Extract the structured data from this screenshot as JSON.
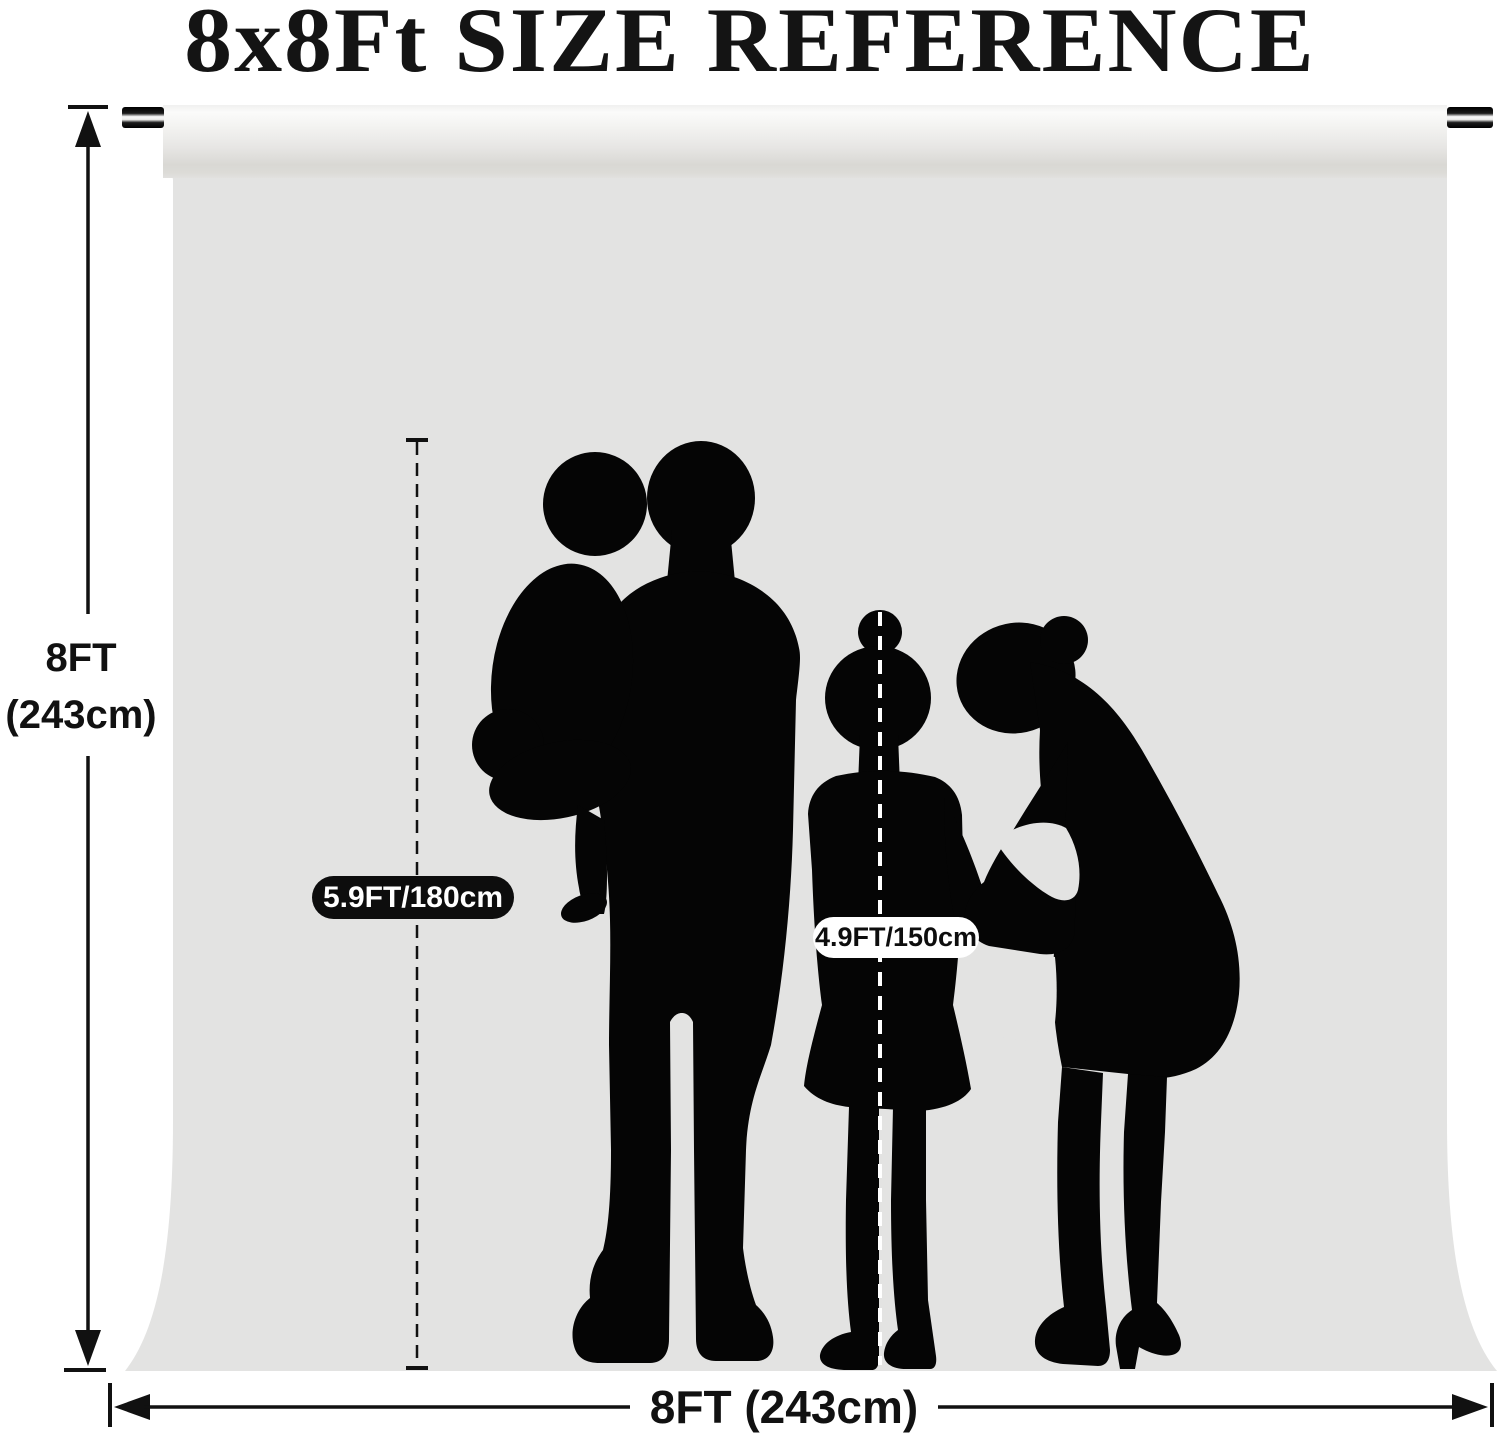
{
  "title": "8x8Ft SIZE REFERENCE",
  "backdrop": {
    "height_label_line1": "8FT",
    "height_label_line2": "(243cm)",
    "width_label": "8FT (243cm)"
  },
  "figures": {
    "adult_height_label": "5.9FT/180cm",
    "child_height_label": "4.9FT/150cm"
  },
  "colors": {
    "page_background": "#ffffff",
    "backdrop_gray": "#e3e3e2",
    "silhouette_black": "#050505",
    "dimension_line": "#111111",
    "adult_pill_background": "#0d0d0d",
    "adult_pill_text": "#ffffff",
    "child_pill_background": "#ffffff",
    "child_pill_text": "#0d0d0d"
  }
}
